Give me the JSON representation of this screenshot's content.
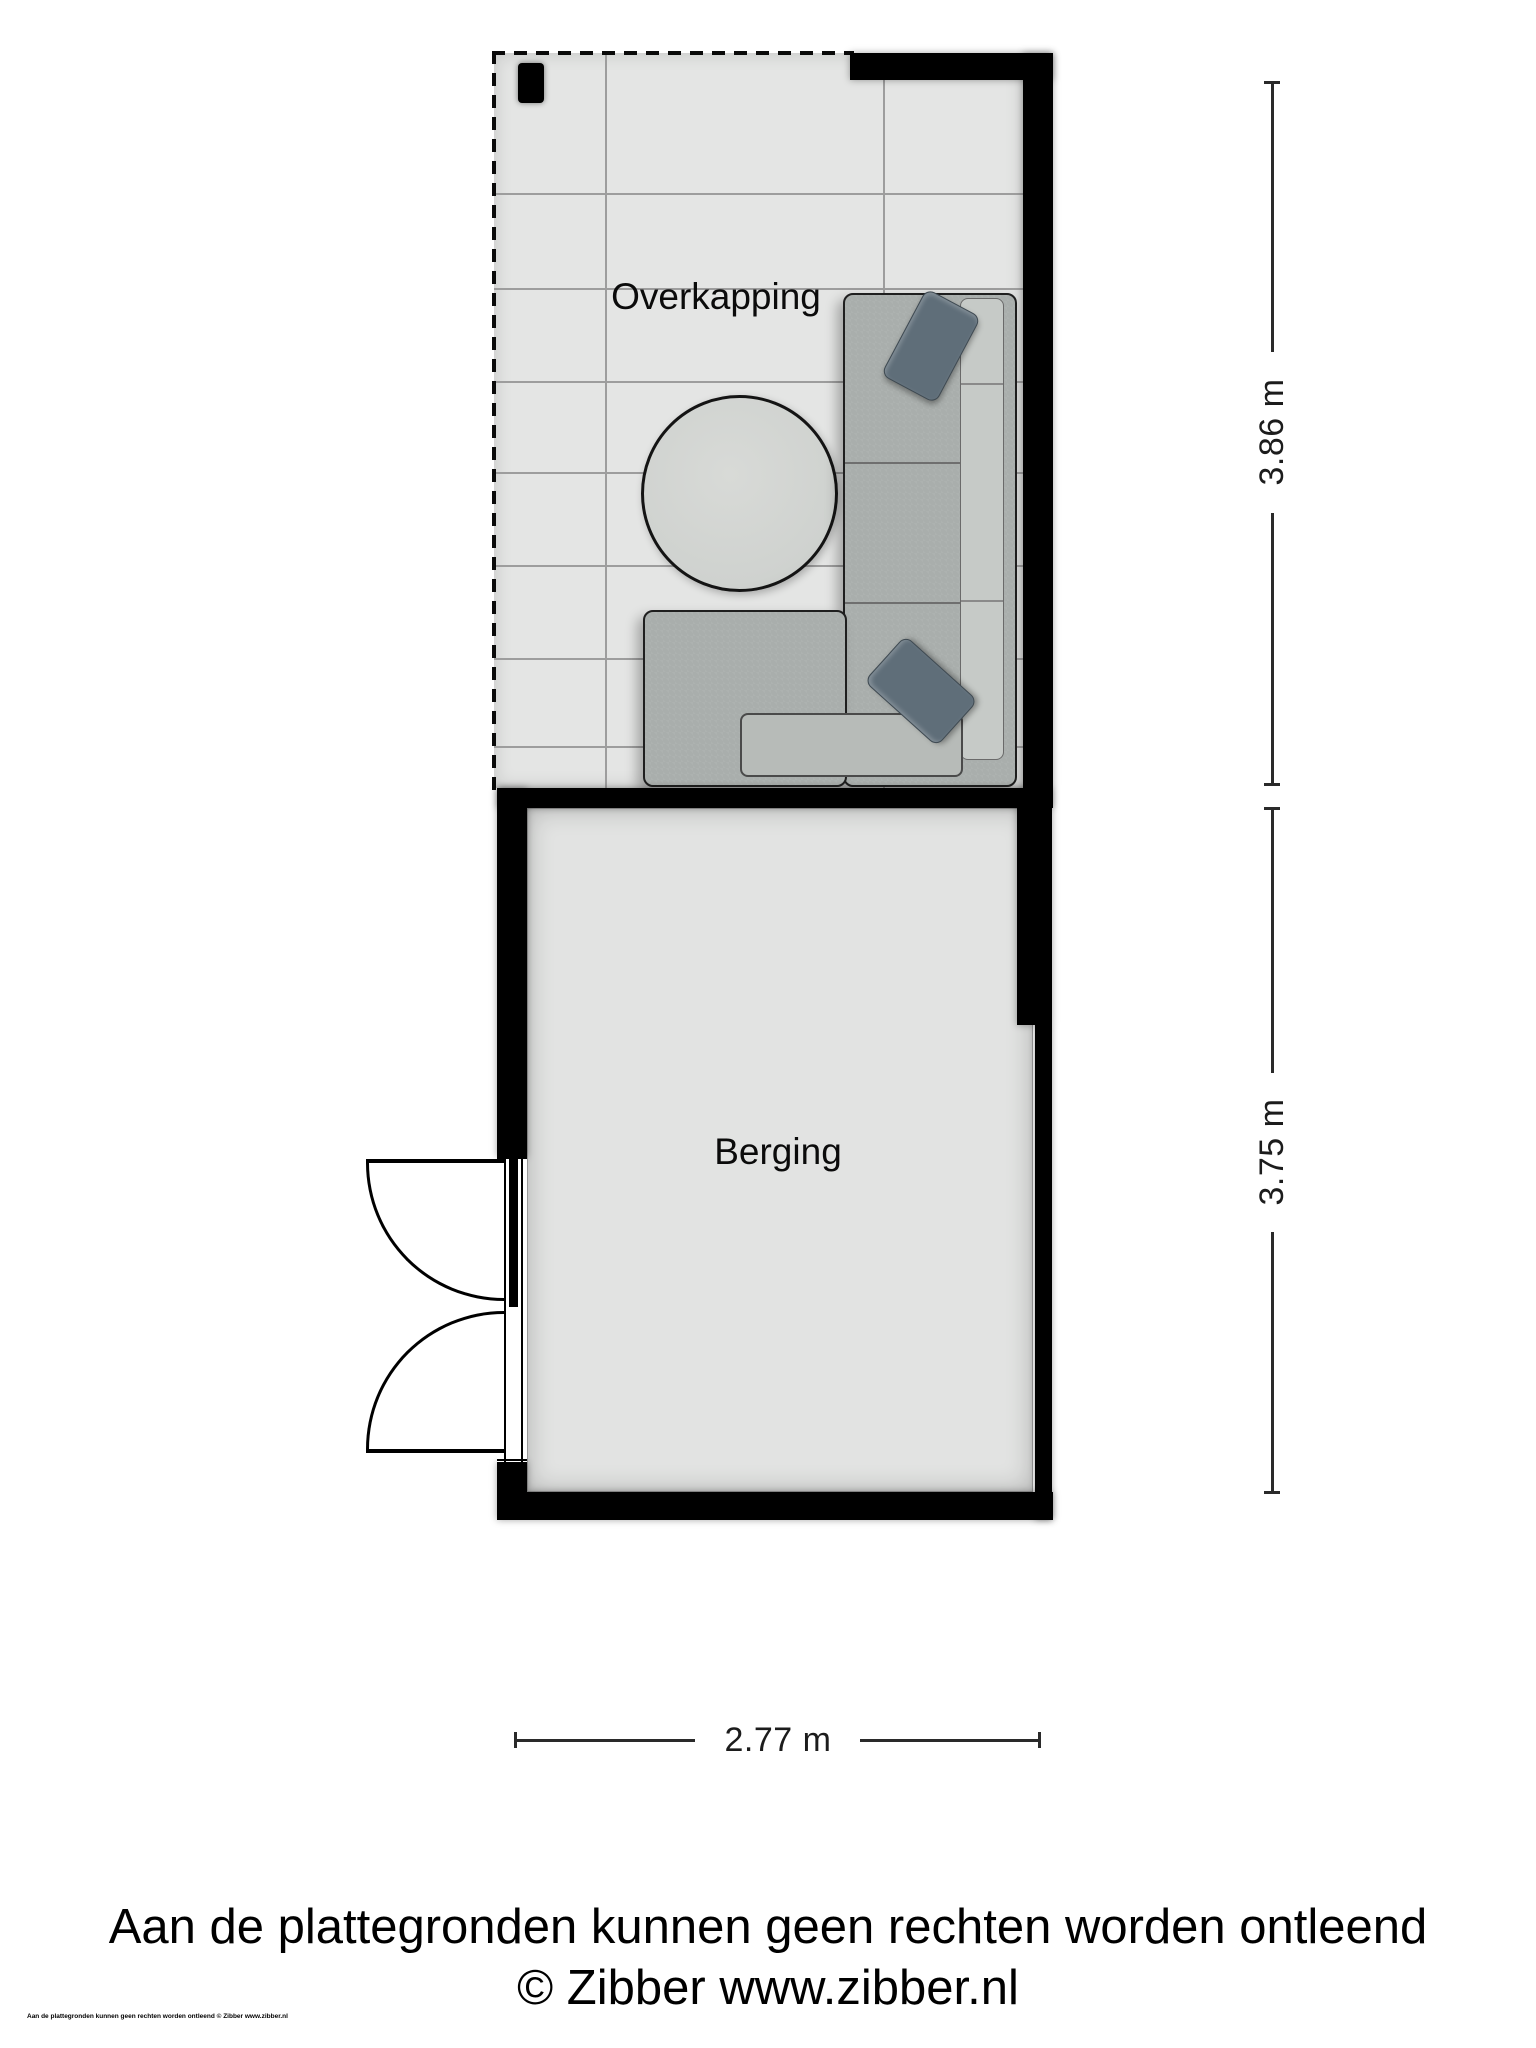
{
  "rooms": {
    "overkapping": {
      "label": "Overkapping"
    },
    "berging": {
      "label": "Berging"
    }
  },
  "dimensions": {
    "right_top": {
      "label": "3.86 m"
    },
    "right_bottom": {
      "label": "3.75 m"
    },
    "bottom": {
      "label": "2.77 m"
    }
  },
  "footer": {
    "disclaimer": "Aan de plattegronden kunnen geen rechten worden ontleend",
    "credit": "© Zibber www.zibber.nl",
    "micro_print": "Aan de plattegronden kunnen geen rechten worden ontleend © Zibber www.zibber.nl"
  },
  "colors": {
    "wall": "#000000",
    "floor": "#e4e5e4",
    "floor_berging": "#e2e3e2",
    "sofa": "#a9aeac",
    "sofa_back": "#c6cac7",
    "pillow": "#5f6e79",
    "table": "#cfd2cf",
    "dimension": "#2a2a2a",
    "grid": "#9d9d9d"
  }
}
